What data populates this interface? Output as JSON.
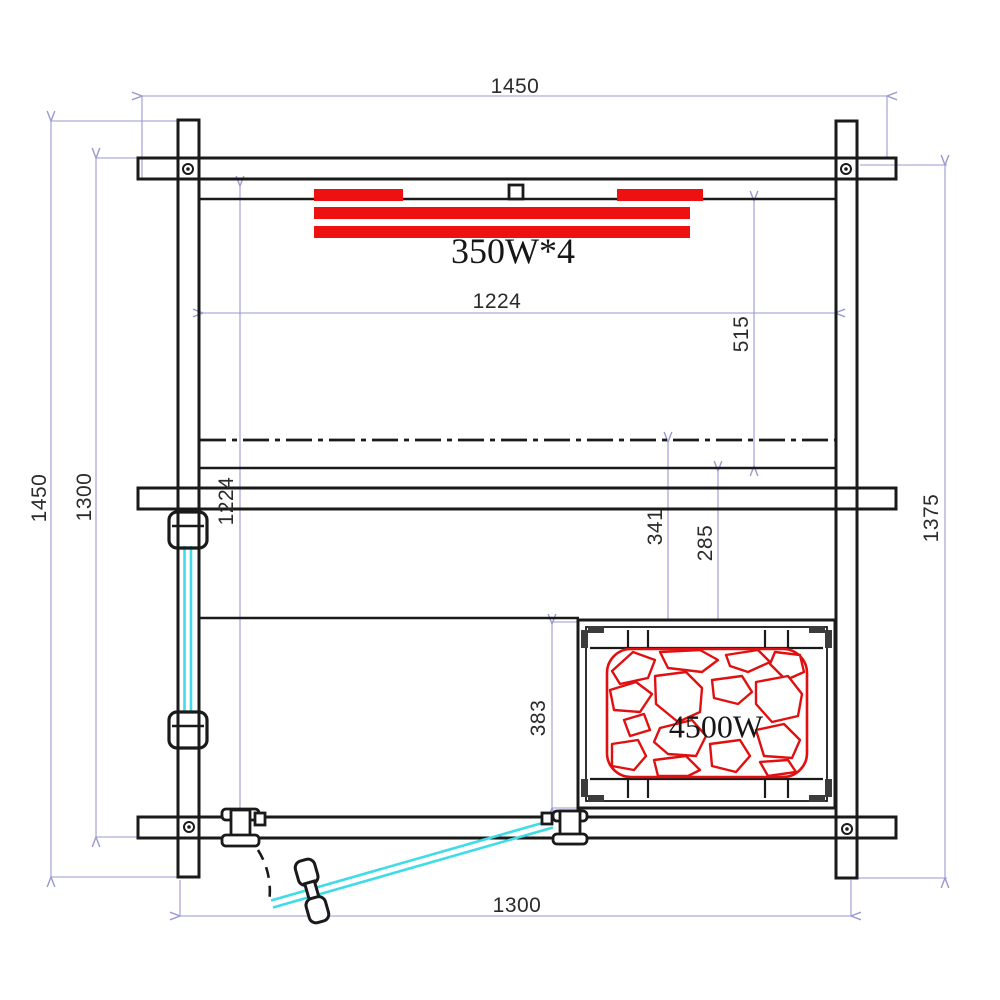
{
  "drawing": {
    "title": "Sauna room plan view",
    "colors": {
      "line": "#1a1a1a",
      "dimension": "#9a9ad2",
      "heater_red": "#ee1111",
      "glass_cyan": "#3fdce8"
    }
  },
  "labels": {
    "ceiling_heaters": "350W*4",
    "stove_power": "4500W"
  },
  "dimensions": {
    "top_width": "1450",
    "left_outer_height": "1450",
    "left_inner_height": "1300",
    "inner_height": "1224",
    "inner_width": "1224",
    "back_to_bench": "515",
    "centerline_to_heater": "341",
    "bench_to_heater": "285",
    "right_height": "1375",
    "heater_depth": "383",
    "bottom_width": "1300"
  }
}
